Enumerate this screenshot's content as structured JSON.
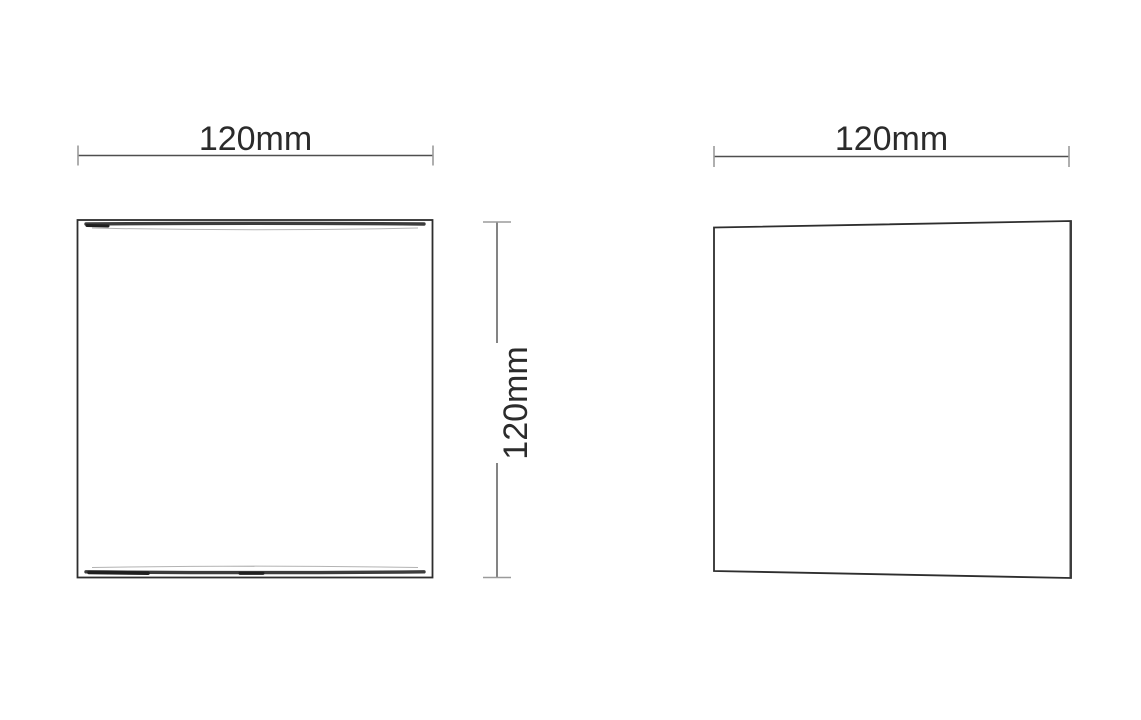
{
  "page": {
    "background": "#ffffff",
    "kind": "technical dimension drawing, two orthographic views of a square wall fixture"
  },
  "colors": {
    "outline": "#2e2e2e",
    "dimension_line": "#4f4f4f",
    "tick": "#9b9b9b",
    "text": "#2b2b2b",
    "band": "#3c3c3c",
    "band_dark": "#1f1f1f",
    "band_faint": "#b3b3b3"
  },
  "views": {
    "front": {
      "width_dimension": {
        "label": "120mm",
        "value_mm": 120
      },
      "height_dimension": {
        "label": "120mm",
        "value_mm": 120
      }
    },
    "side": {
      "depth_dimension": {
        "label": "120mm",
        "value_mm": 120
      }
    }
  }
}
